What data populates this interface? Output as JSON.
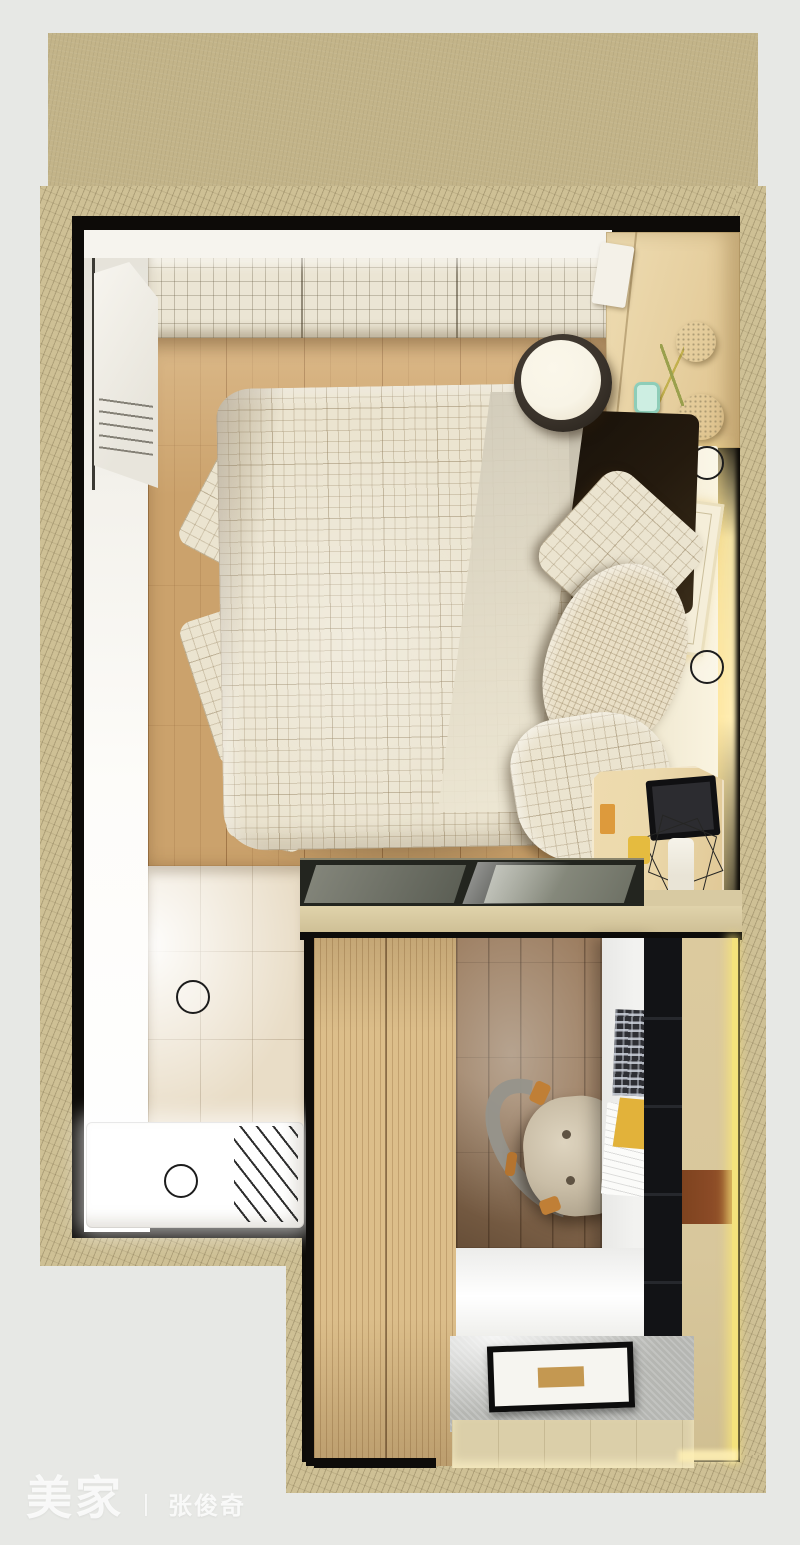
{
  "watermark": {
    "brand": "美家",
    "separator": "丨",
    "author": "张俊奇"
  },
  "scene": {
    "description": "Top-down 3D interior render of a small apartment: bedroom with double bed, bathroom with shower, and a study nook with desk, chair and wardrobes",
    "rooms": [
      "bedroom",
      "bathroom",
      "study"
    ],
    "objects": [
      "double-bed",
      "checkered-duvet",
      "knit-pillow",
      "checkered-pillows",
      "round-side-table",
      "bedside-cabinet",
      "wire-frame-lamp",
      "dresser-with-flowers",
      "open-door",
      "shower-tray",
      "floor-drain",
      "downlights",
      "glass-partition",
      "wood-wardrobe",
      "white-desk",
      "laptop",
      "office-chair",
      "black-shelving-unit",
      "led-light-strip",
      "gray-rug",
      "framed-floor-mat",
      "picture-frame"
    ]
  },
  "palette": {
    "bg": "#e7e8e5",
    "slab": "#c3b489",
    "wall": "#cec095",
    "blackGap": "#0d0b08",
    "wallFace": "#f6f4ee",
    "mosaic": "#ebe5d4",
    "bedroomFloor": "#cba26c",
    "bathTile": "#e9ddc7",
    "shower": "#ffffff",
    "duvet": "#ebe4d0",
    "knitPillow": "#e9dfc6",
    "headboard": "#f3ecd6",
    "warmGlow": "#ffeeb7",
    "darkBedding": "#241a0e",
    "stoolSide": "#39322a",
    "stoolTop": "#f8f4e6",
    "cabinetWood": "#ead8ad",
    "tealSwitch": "#cdeee2",
    "nightstandWood": "#ecd9ac",
    "lampBlack": "#262624",
    "mugYellow": "#e5bb3f",
    "glass": "#23251f",
    "beam": "#d8caa2",
    "wardrobe": "#dcbe8a",
    "studyFloor": "#9a7a5c",
    "desk": "#f2f2f0",
    "laptop": "#2e2f34",
    "notebookYellow": "#e2b23a",
    "blackUnit": "#121316",
    "tanPanel": "#d8c79c",
    "brownBand": "#8a4a26",
    "ledStrip": "#f4e27c",
    "rug": "#b5b6b2",
    "matFrame": "#0d0d0d",
    "matCenter": "#c49851",
    "chair": "#c9bda6",
    "chairAccent": "#c07f36",
    "watermark": "rgba(255,255,255,0.8)"
  }
}
